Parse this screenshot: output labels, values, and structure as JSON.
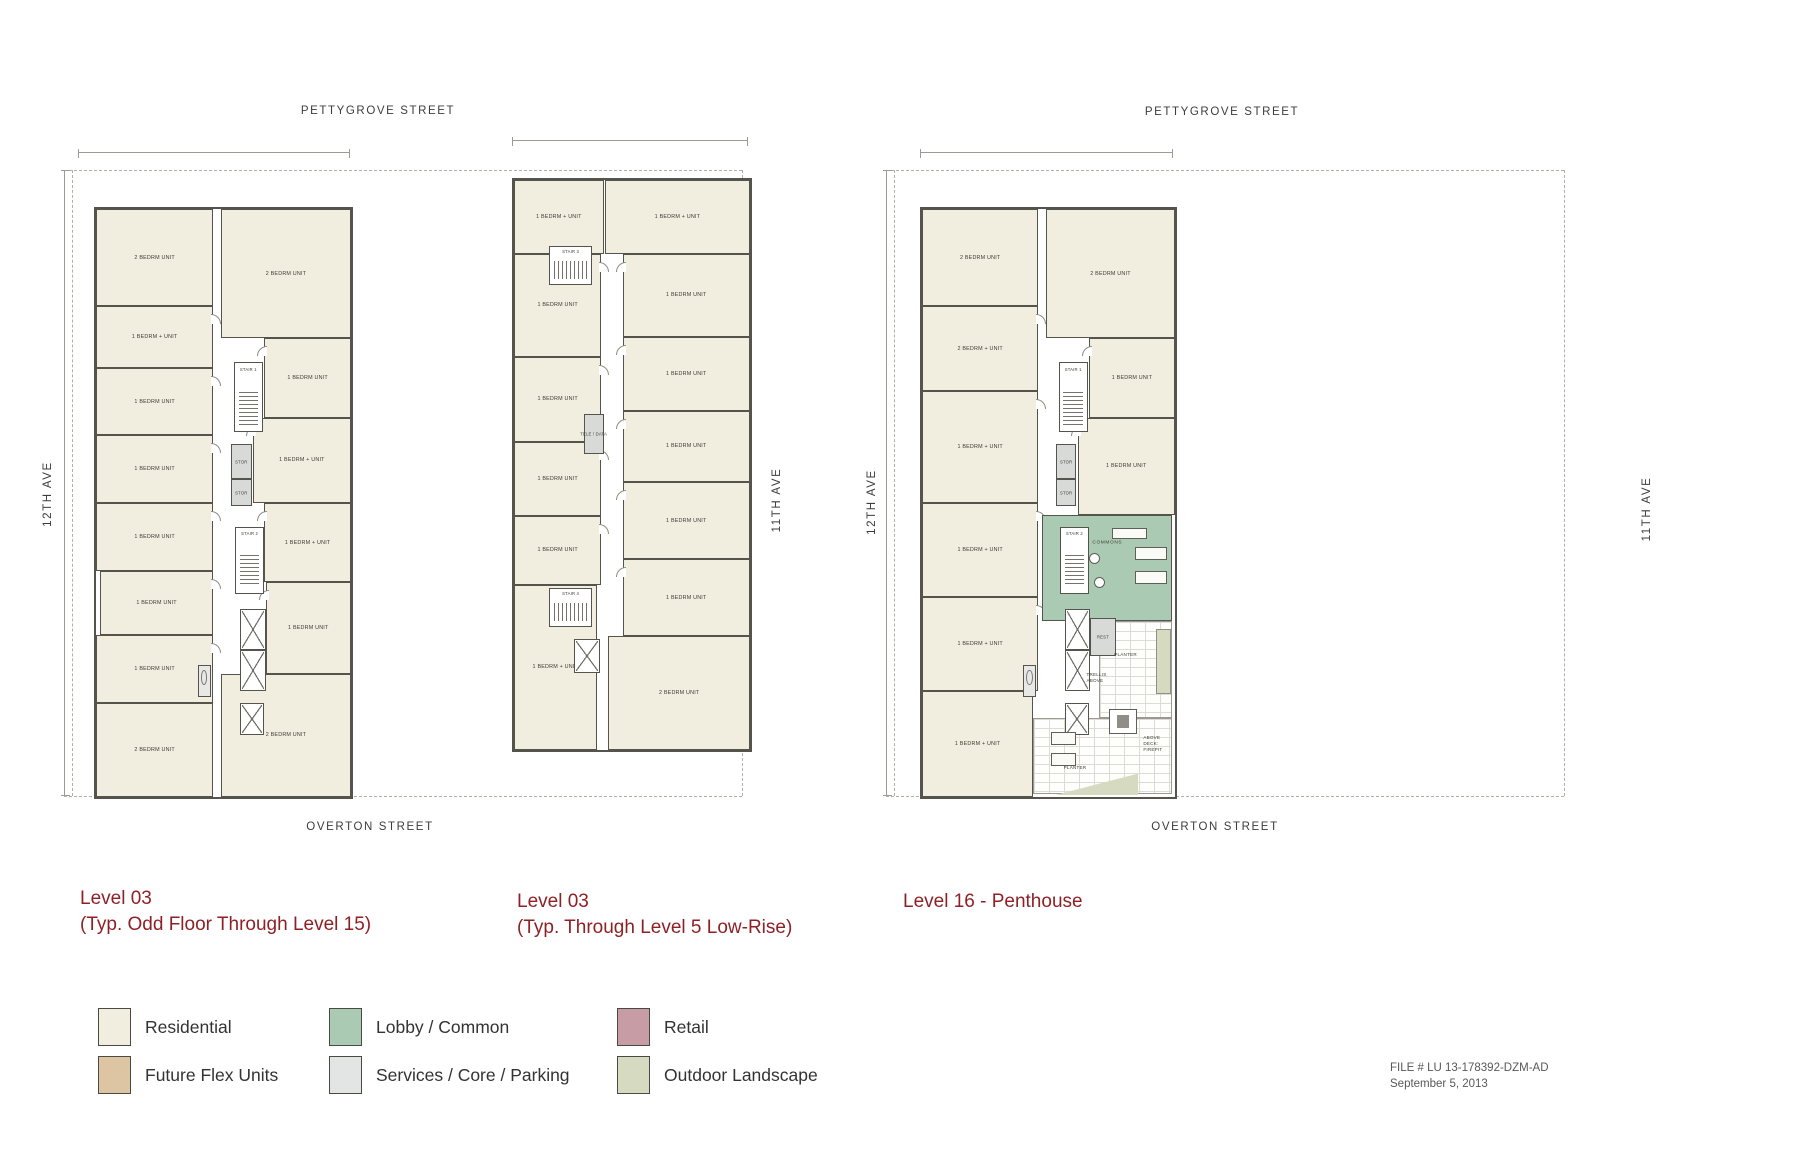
{
  "streets": {
    "pettygrove": "PETTYGROVE STREET",
    "overton": "OVERTON STREET",
    "twelfth": "12TH AVE",
    "eleventh": "11TH AVE"
  },
  "titles": {
    "p1a": "Level 03",
    "p1b": "(Typ. Odd Floor Through Level 15)",
    "p2a": "Level 03",
    "p2b": "(Typ. Through Level 5 Low-Rise)",
    "p3": "Level 16 - Penthouse"
  },
  "footer": {
    "file": "FILE #  LU 13-178392-DZM-AD",
    "date": "September 5, 2013"
  },
  "legend": {
    "items": [
      {
        "label": "Residential",
        "color": "#f2eedf"
      },
      {
        "label": "Lobby / Common",
        "color": "#abcab3"
      },
      {
        "label": "Retail",
        "color": "#c79ca4"
      },
      {
        "label": "Future Flex Units",
        "color": "#ddc5a3"
      },
      {
        "label": "Services / Core / Parking",
        "color": "#e3e5e4"
      },
      {
        "label": "Outdoor Landscape",
        "color": "#d6dac0"
      }
    ]
  },
  "plans": [
    {
      "name": "floor-plan-level03-tower",
      "bbox": {
        "x": 94,
        "y": 207,
        "w": 255,
        "h": 588
      },
      "features": [
        {
          "t": "room",
          "label": "2 BEDRM UNIT",
          "x": 0,
          "y": 0,
          "w": 46,
          "h": 16.5
        },
        {
          "t": "room",
          "label": "1 BEDRM + UNIT",
          "x": 0,
          "y": 16.5,
          "w": 46,
          "h": 10.5,
          "door": "r"
        },
        {
          "t": "room",
          "label": "1 BEDRM UNIT",
          "x": 0,
          "y": 27,
          "w": 46,
          "h": 11.5,
          "door": "r"
        },
        {
          "t": "room",
          "label": "1 BEDRM UNIT",
          "x": 0,
          "y": 38.5,
          "w": 46,
          "h": 11.5,
          "door": "r"
        },
        {
          "t": "room",
          "label": "1 BEDRM UNIT",
          "x": 0,
          "y": 50,
          "w": 46,
          "h": 11.5,
          "door": "r"
        },
        {
          "t": "room",
          "label": "1 BEDRM UNIT",
          "x": 1.5,
          "y": 61.5,
          "w": 44.5,
          "h": 11,
          "door": "r"
        },
        {
          "t": "room",
          "label": "1 BEDRM UNIT",
          "x": 0,
          "y": 72.5,
          "w": 46,
          "h": 11.5,
          "door": "r"
        },
        {
          "t": "room",
          "label": "2 BEDRM UNIT",
          "x": 0,
          "y": 84,
          "w": 46,
          "h": 16
        },
        {
          "t": "room",
          "label": "2 BEDRM UNIT",
          "x": 49,
          "y": 0,
          "w": 51,
          "h": 22
        },
        {
          "t": "room",
          "label": "1 BEDRM UNIT",
          "x": 66,
          "y": 22,
          "w": 34,
          "h": 13.5,
          "door": "l"
        },
        {
          "t": "room",
          "label": "1 BEDRM + UNIT",
          "x": 61.5,
          "y": 35.5,
          "w": 38.5,
          "h": 14.5,
          "door": "l"
        },
        {
          "t": "room",
          "label": "1 BEDRM + UNIT",
          "x": 66,
          "y": 50,
          "w": 34,
          "h": 13.5,
          "door": "l"
        },
        {
          "t": "room",
          "label": "1 BEDRM UNIT",
          "x": 66.5,
          "y": 63.5,
          "w": 33.5,
          "h": 15.5,
          "door": "l"
        },
        {
          "t": "room",
          "label": "2 BEDRM UNIT",
          "x": 49,
          "y": 79,
          "w": 51,
          "h": 21
        },
        {
          "t": "stair",
          "label": "STAIR 1",
          "x": 54,
          "y": 26,
          "w": 11.5,
          "h": 12
        },
        {
          "t": "stor",
          "label": "STOR",
          "x": 53,
          "y": 40,
          "w": 8,
          "h": 6
        },
        {
          "t": "stor",
          "label": "STOR",
          "x": 53,
          "y": 46,
          "w": 8,
          "h": 4.5
        },
        {
          "t": "stair",
          "label": "STAIR 2",
          "x": 54.5,
          "y": 54,
          "w": 11.5,
          "h": 11.5
        },
        {
          "t": "elev",
          "x": 56.5,
          "y": 68,
          "w": 10,
          "h": 7
        },
        {
          "t": "elev",
          "x": 56.5,
          "y": 75,
          "w": 10,
          "h": 7
        },
        {
          "t": "elev",
          "x": 56.5,
          "y": 84,
          "w": 9.5,
          "h": 5.5
        },
        {
          "t": "kitchen",
          "x": 40,
          "y": 77.5,
          "w": 5,
          "h": 5.5
        }
      ]
    },
    {
      "name": "floor-plan-level03-lowrise",
      "bbox": {
        "x": 512,
        "y": 178,
        "w": 236,
        "h": 570
      },
      "features": [
        {
          "t": "room",
          "label": "1 BEDRM + UNIT",
          "x": 0,
          "y": 0,
          "w": 38,
          "h": 13
        },
        {
          "t": "room",
          "label": "1 BEDRM UNIT",
          "x": 0,
          "y": 13,
          "w": 37,
          "h": 18,
          "door": "r"
        },
        {
          "t": "room",
          "label": "1 BEDRM UNIT",
          "x": 0,
          "y": 31,
          "w": 37,
          "h": 15,
          "door": "r"
        },
        {
          "t": "room",
          "label": "1 BEDRM UNIT",
          "x": 0,
          "y": 46,
          "w": 37,
          "h": 13,
          "door": "r"
        },
        {
          "t": "room",
          "label": "1 BEDRM UNIT",
          "x": 0,
          "y": 59,
          "w": 37,
          "h": 12,
          "door": "r"
        },
        {
          "t": "room",
          "label": "1 BEDRM + UNIT",
          "x": 0,
          "y": 71,
          "w": 35,
          "h": 29
        },
        {
          "t": "room",
          "label": "1 BEDRM + UNIT",
          "x": 38.5,
          "y": 0,
          "w": 61.5,
          "h": 13
        },
        {
          "t": "room",
          "label": "1 BEDRM UNIT",
          "x": 46,
          "y": 13,
          "w": 54,
          "h": 14.5,
          "door": "l"
        },
        {
          "t": "room",
          "label": "1 BEDRM UNIT",
          "x": 46,
          "y": 27.5,
          "w": 54,
          "h": 13,
          "door": "l"
        },
        {
          "t": "room",
          "label": "1 BEDRM UNIT",
          "x": 46,
          "y": 40.5,
          "w": 54,
          "h": 12.5,
          "door": "l"
        },
        {
          "t": "room",
          "label": "1 BEDRM UNIT",
          "x": 46,
          "y": 53,
          "w": 54,
          "h": 13.5,
          "door": "l"
        },
        {
          "t": "room",
          "label": "1 BEDRM UNIT",
          "x": 46,
          "y": 66.5,
          "w": 54,
          "h": 13.5,
          "door": "l"
        },
        {
          "t": "room",
          "label": "2 BEDRM UNIT",
          "x": 40,
          "y": 80,
          "w": 60,
          "h": 20
        },
        {
          "t": "stair",
          "label": "STAIR 3",
          "x": 15,
          "y": 11.5,
          "w": 18,
          "h": 7,
          "o": "h"
        },
        {
          "t": "tele",
          "label": "TELE / DATA",
          "x": 29.5,
          "y": 41,
          "w": 8.5,
          "h": 7
        },
        {
          "t": "stair",
          "label": "STAIR 4",
          "x": 15,
          "y": 71.5,
          "w": 18,
          "h": 7,
          "o": "h"
        },
        {
          "t": "elev",
          "x": 25.5,
          "y": 80.5,
          "w": 11,
          "h": 6
        }
      ]
    },
    {
      "name": "floor-plan-level16-penthouse",
      "bbox": {
        "x": 920,
        "y": 207,
        "w": 253,
        "h": 588
      },
      "features": [
        {
          "t": "room",
          "label": "2 BEDRM UNIT",
          "x": 0,
          "y": 0,
          "w": 46,
          "h": 16.5
        },
        {
          "t": "room",
          "label": "2 BEDRM + UNIT",
          "x": 0,
          "y": 16.5,
          "w": 46,
          "h": 14.5,
          "door": "r"
        },
        {
          "t": "room",
          "label": "1 BEDRM + UNIT",
          "x": 0,
          "y": 31,
          "w": 46,
          "h": 19,
          "door": "r"
        },
        {
          "t": "room",
          "label": "1 BEDRM + UNIT",
          "x": 0,
          "y": 50,
          "w": 46,
          "h": 16,
          "door": "r"
        },
        {
          "t": "room",
          "label": "1 BEDRM + UNIT",
          "x": 0,
          "y": 66,
          "w": 46,
          "h": 16,
          "door": "r"
        },
        {
          "t": "room",
          "label": "1 BEDRM + UNIT",
          "x": 0,
          "y": 82,
          "w": 44,
          "h": 18
        },
        {
          "t": "room",
          "label": "2 BEDRM UNIT",
          "x": 49,
          "y": 0,
          "w": 51,
          "h": 22
        },
        {
          "t": "room",
          "label": "1 BEDRM UNIT",
          "x": 66,
          "y": 22,
          "w": 34,
          "h": 13.5,
          "door": "l"
        },
        {
          "t": "room",
          "label": "1 BEDRM UNIT",
          "x": 61.5,
          "y": 35.5,
          "w": 38.5,
          "h": 16.5,
          "door": "l"
        },
        {
          "t": "stair",
          "label": "STAIR 1",
          "x": 54,
          "y": 26,
          "w": 11.5,
          "h": 12
        },
        {
          "t": "stor",
          "label": "STOR",
          "x": 53,
          "y": 40,
          "w": 8,
          "h": 6
        },
        {
          "t": "stor",
          "label": "STOR",
          "x": 53,
          "y": 46,
          "w": 8,
          "h": 4.5
        },
        {
          "t": "commons",
          "label": "COMMONS",
          "x": 47.5,
          "y": 52,
          "w": 51.5,
          "h": 18
        },
        {
          "t": "stair",
          "label": "STAIR 2",
          "x": 54.5,
          "y": 54,
          "w": 11.5,
          "h": 11.5
        },
        {
          "t": "deck",
          "x": 70,
          "y": 70,
          "w": 29,
          "h": 16.5
        },
        {
          "t": "deck",
          "x": 44,
          "y": 86.5,
          "w": 55,
          "h": 13
        },
        {
          "t": "elev",
          "x": 56.5,
          "y": 68,
          "w": 10,
          "h": 7
        },
        {
          "t": "elev",
          "x": 56.5,
          "y": 75,
          "w": 10,
          "h": 7
        },
        {
          "t": "elev",
          "x": 56.5,
          "y": 84,
          "w": 9.5,
          "h": 5.5
        },
        {
          "t": "kitchen",
          "x": 40,
          "y": 77.5,
          "w": 5,
          "h": 5.5
        },
        {
          "t": "rest",
          "label": "REST",
          "x": 66.5,
          "y": 69.5,
          "w": 10,
          "h": 6.5
        },
        {
          "t": "planter",
          "x": 92.5,
          "y": 71.5,
          "w": 6,
          "h": 11
        },
        {
          "t": "tri",
          "x": 52.5,
          "y": 96,
          "w": 33,
          "h": 3.7
        },
        {
          "t": "rtable",
          "x": 66,
          "y": 58.5
        },
        {
          "t": "rtable",
          "x": 68,
          "y": 62.5
        },
        {
          "t": "sofa",
          "x": 75,
          "y": 54.3,
          "w": 14,
          "h": 1.8
        },
        {
          "t": "sofa",
          "x": 84,
          "y": 57.5,
          "w": 13,
          "h": 2.2
        },
        {
          "t": "sofa",
          "x": 84,
          "y": 61.5,
          "w": 13,
          "h": 2.2
        },
        {
          "t": "firepit",
          "x": 74,
          "y": 85,
          "w": 11,
          "h": 4.3
        },
        {
          "t": "sofa",
          "x": 51,
          "y": 89,
          "w": 10,
          "h": 2.2
        },
        {
          "t": "sofa",
          "x": 51,
          "y": 92.5,
          "w": 10,
          "h": 2.2
        },
        {
          "t": "dlabel",
          "label": "PLANTER",
          "x": 76,
          "y": 75.3
        },
        {
          "t": "dlabel",
          "label": "TRELLIS\nABOVE",
          "x": 65,
          "y": 78.8
        },
        {
          "t": "dlabel",
          "label": "ABOVE\nDECK:\nFIREPIT",
          "x": 87.5,
          "y": 89.5
        },
        {
          "t": "dlabel",
          "label": "PLANTER",
          "x": 56,
          "y": 94.6
        }
      ]
    }
  ]
}
